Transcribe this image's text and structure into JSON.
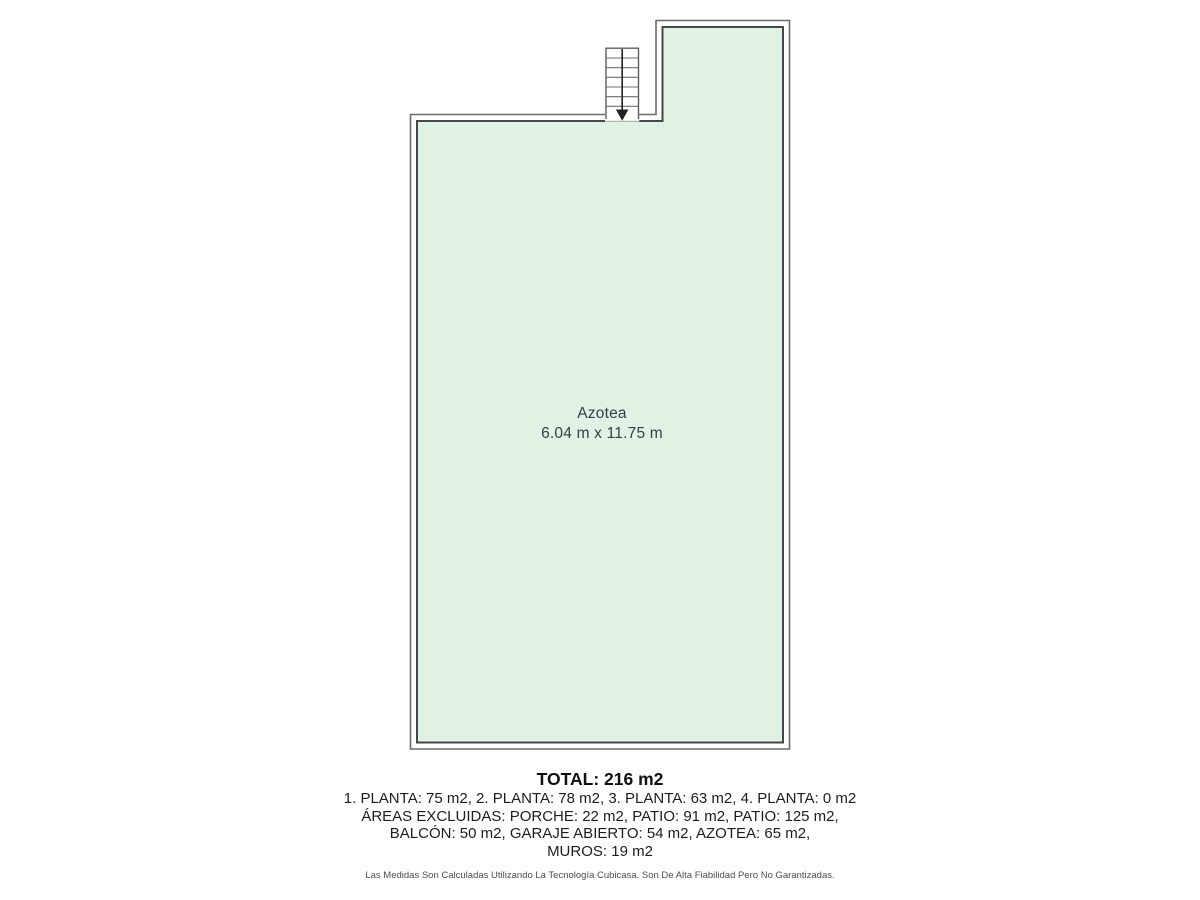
{
  "floorplan": {
    "room": {
      "name": "Azotea",
      "dimensions": "6.04 m x 11.75 m"
    },
    "colors": {
      "room_fill": "#e0f2e4",
      "wall_inner": "#474747",
      "wall_outer": "#6b6b6b",
      "label_text": "#333e48"
    },
    "stairs": {
      "direction": "down",
      "treads": 6
    }
  },
  "summary": {
    "total": "TOTAL: 216 m2",
    "lines": [
      "1. PLANTA: 75 m2, 2. PLANTA: 78 m2, 3. PLANTA: 63 m2, 4. PLANTA: 0 m2",
      "ÁREAS EXCLUIDAS: PORCHE: 22 m2, PATIO: 91 m2, PATIO: 125 m2,",
      "BALCÓN: 50 m2, GARAJE ABIERTO: 54 m2, AZOTEA: 65 m2,",
      "MUROS: 19 m2"
    ],
    "disclaimer": "Las Medidas Son Calculadas Utilizando La Tecnología Cubicasa. Son De Alta Fiabilidad Pero No Garantizadas."
  }
}
